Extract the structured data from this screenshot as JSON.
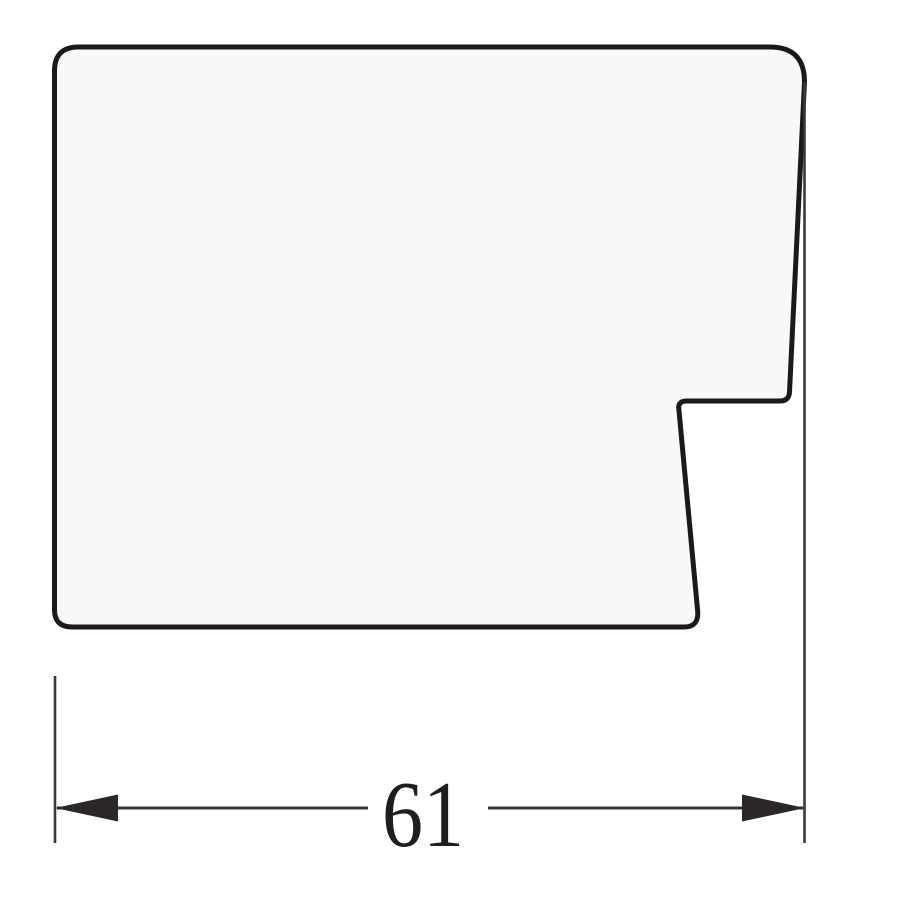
{
  "canvas": {
    "background": "#ffffff"
  },
  "profile": {
    "description": "frame moulding cross-section profile",
    "fill": "#f8f8f8",
    "outline_color": "#1c1918",
    "outline_width": "5"
  },
  "dimension": {
    "label": "61",
    "line_color": "#3b3838",
    "arrow_color": "#2b2727",
    "text_color": "#201d1d",
    "font_size": "94"
  }
}
